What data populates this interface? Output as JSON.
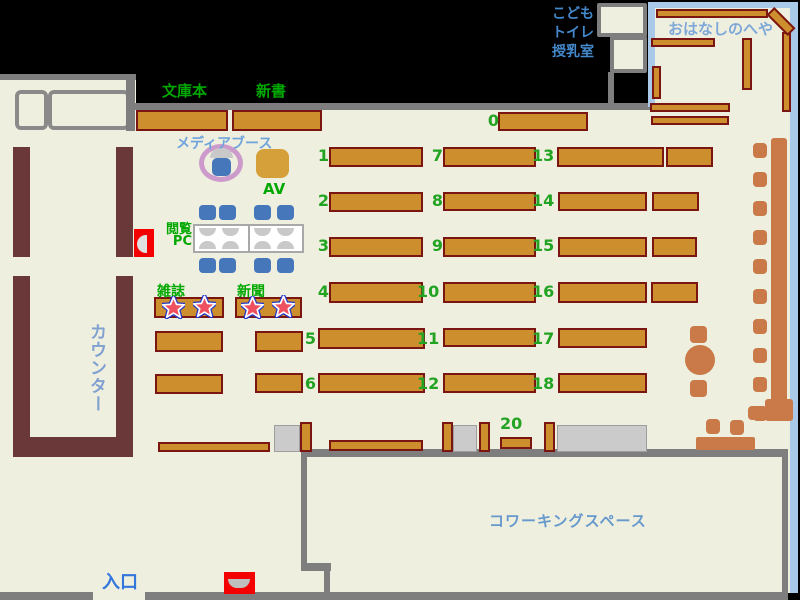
{
  "title": "library-floor-map",
  "palette": {
    "background": "#000000",
    "floor": "#EFEFDF",
    "wall_gray": "#7E7E7E",
    "counter_brown": "#6A3839",
    "shelf_fill": "#CD8E2D",
    "shelf_border": "#7B1512",
    "seat_orange": "#C97A48",
    "chair_blue": "#4777BB",
    "media_ring_plum": "#CC9BCC",
    "av_gold": "#D5A039",
    "alert_red": "#F50000",
    "green_label": "#00A800",
    "number_green": "#22A322",
    "room_border_blue": "#A9C9E9",
    "star_fill": "#EE5060",
    "star_ring": "#2236C8"
  },
  "labels": {
    "kodomo_lines": [
      "こども",
      "トイレ",
      "授乳室"
    ],
    "bunkobon": "文庫本",
    "shinsho": "新書",
    "ohanashi_room": "おはなしのへや",
    "media_booth": "メディアブース",
    "av": "AV",
    "etsuran_line1": "閲覧",
    "etsuran_line2": "PC",
    "zasshi": "雑誌",
    "shinbun": "新聞",
    "counter": "カウンター",
    "entrance": "入口",
    "coworking": "コワーキングスペース"
  },
  "shelf_numbers": [
    "0",
    "1",
    "2",
    "3",
    "4",
    "5",
    "6",
    "7",
    "8",
    "9",
    "10",
    "11",
    "12",
    "13",
    "14",
    "15",
    "16",
    "17",
    "18",
    "20"
  ]
}
